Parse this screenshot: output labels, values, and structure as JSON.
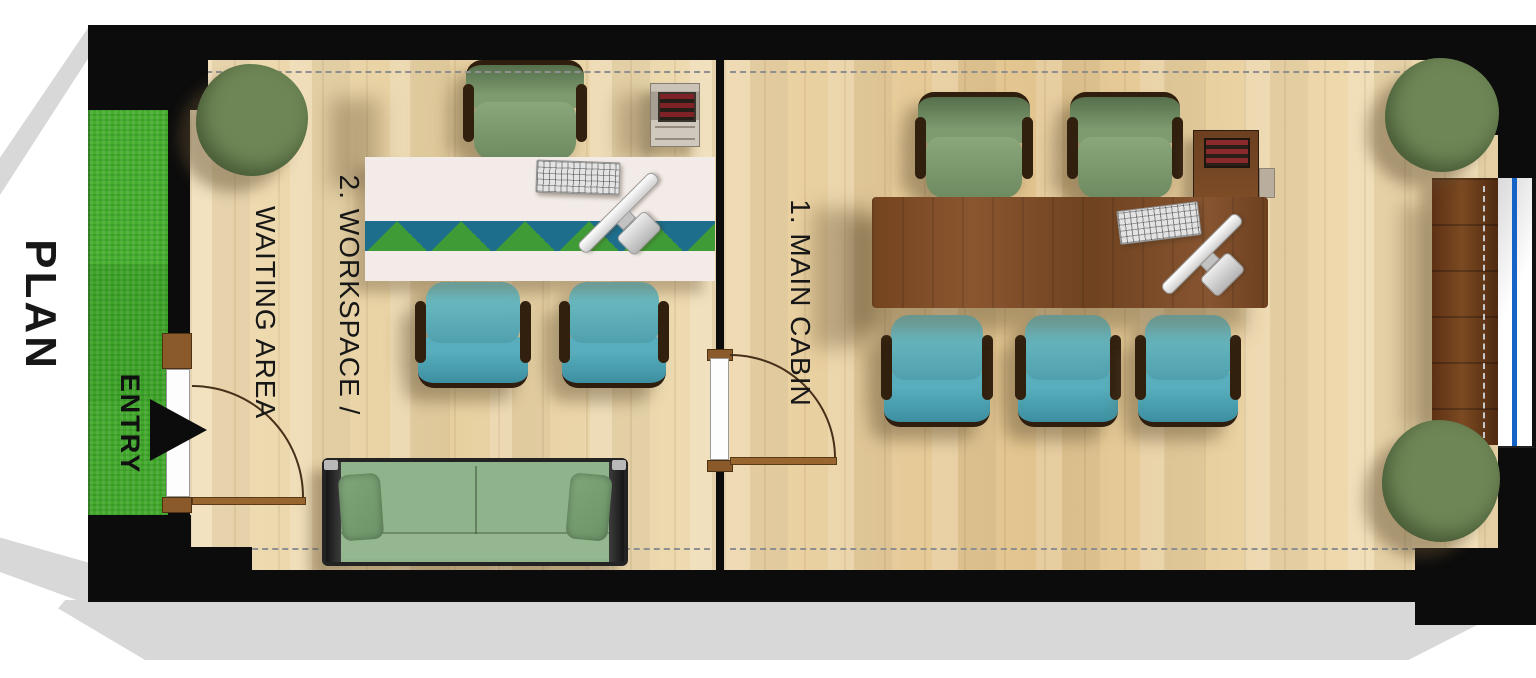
{
  "title": "PLAN",
  "entry": {
    "label": "ENTRY"
  },
  "rooms": {
    "main_cabin": {
      "label": "1. MAIN CABIN"
    },
    "workspace": {
      "label_line1": "2. WORKSPACE /",
      "label_line2": "WAITING AREA"
    }
  },
  "objects": {
    "workspace": [
      "potted-plant",
      "desk-chair-green",
      "reception-desk",
      "keyboard",
      "monitor",
      "printer-stand",
      "visitor-chair-teal",
      "visitor-chair-teal",
      "sofa",
      "entry-door",
      "entry-arrow",
      "grass-strip"
    ],
    "main_cabin": [
      "desk-chair-green",
      "desk-chair-green",
      "executive-desk",
      "keyboard",
      "monitor",
      "vent-cabinet",
      "visitor-chair-teal",
      "visitor-chair-teal",
      "visitor-chair-teal",
      "interior-door",
      "sideboard",
      "window",
      "potted-plant",
      "potted-plant"
    ]
  },
  "colors": {
    "wall": "#0c0c0c",
    "floor_light": "#edd9ae",
    "grass": "#3fa32b",
    "desk_wood": "#7b4a22",
    "reception_band_teal": "#1d6e8c",
    "reception_band_green": "#3f9b35",
    "chair_green": "#7e9a6f",
    "chair_teal": "#58aebc",
    "sofa_green": "#8fb38a",
    "window_glazing_blue": "#1663c7",
    "door_wood": "#8a5a2a",
    "paper_shadow": "#d8d8d8"
  }
}
